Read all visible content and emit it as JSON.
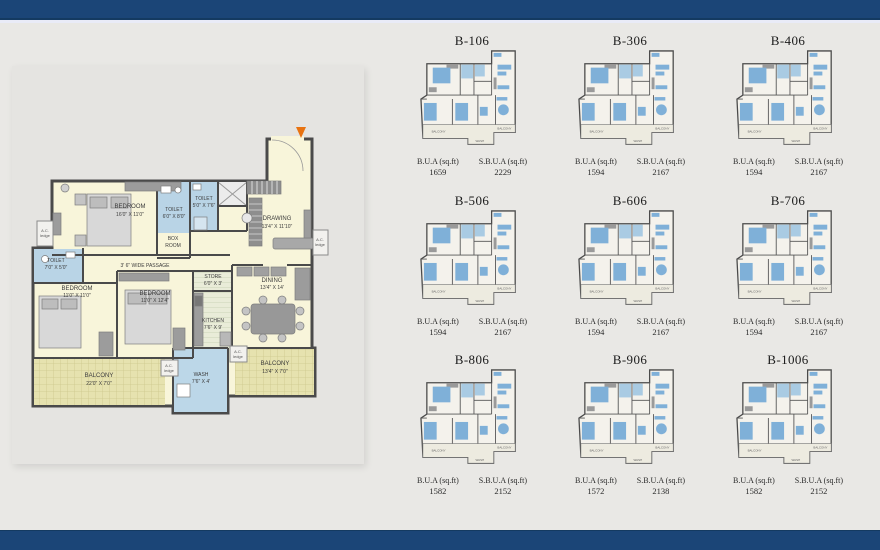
{
  "labels": {
    "bua": "B.U.A (sq.ft)",
    "sbua": "S.B.U.A (sq.ft)"
  },
  "units": [
    {
      "id": "B-106",
      "bua": "1659",
      "sbua": "2229"
    },
    {
      "id": "B-306",
      "bua": "1594",
      "sbua": "2167"
    },
    {
      "id": "B-406",
      "bua": "1594",
      "sbua": "2167"
    },
    {
      "id": "B-506",
      "bua": "1594",
      "sbua": "2167"
    },
    {
      "id": "B-606",
      "bua": "1594",
      "sbua": "2167"
    },
    {
      "id": "B-706",
      "bua": "1594",
      "sbua": "2167"
    },
    {
      "id": "B-806",
      "bua": "1582",
      "sbua": "2152"
    },
    {
      "id": "B-906",
      "bua": "1572",
      "sbua": "2138"
    },
    {
      "id": "B-1006",
      "bua": "1582",
      "sbua": "2152"
    }
  ],
  "floorplan": {
    "passage": "3' 6\" WIDE PASSAGE",
    "ac1": "A.C.",
    "ac2": "ledge",
    "rooms": [
      {
        "name": "BEDROOM",
        "dims": "16'0\" X 11'0\""
      },
      {
        "name": "TOILET",
        "dims": "6'0\" X 8'0\""
      },
      {
        "name": "TOILET",
        "dims": "5'0\" X 7'6\""
      },
      {
        "name": "BOX",
        "dims": "ROOM"
      },
      {
        "name": "DRAWING",
        "dims": "13'4\" X 11'10\""
      },
      {
        "name": "TOILET",
        "dims": "7'0\" X 5'0\""
      },
      {
        "name": "BEDROOM",
        "dims": "11'0\" X 11'0\""
      },
      {
        "name": "BEDROOM",
        "dims": "11'0\" X 12'4\""
      },
      {
        "name": "STORE",
        "dims": "6'0\" X 3'"
      },
      {
        "name": "KITCHEN",
        "dims": "7'6\" X 9'"
      },
      {
        "name": "DINING",
        "dims": "13'4\" X 14'"
      },
      {
        "name": "BALCONY",
        "dims": "22'0\" X 7'0\""
      },
      {
        "name": "WASH",
        "dims": "7'6\" X 4'"
      },
      {
        "name": "BALCONY",
        "dims": "13'4\" X 7'0\""
      }
    ]
  },
  "colors": {
    "navy": "#1b4577",
    "cream": "#f8f5da",
    "toilet_blue": "#b9d4e6",
    "balcony": "#e6e2af",
    "accent_orange": "#e87311"
  }
}
